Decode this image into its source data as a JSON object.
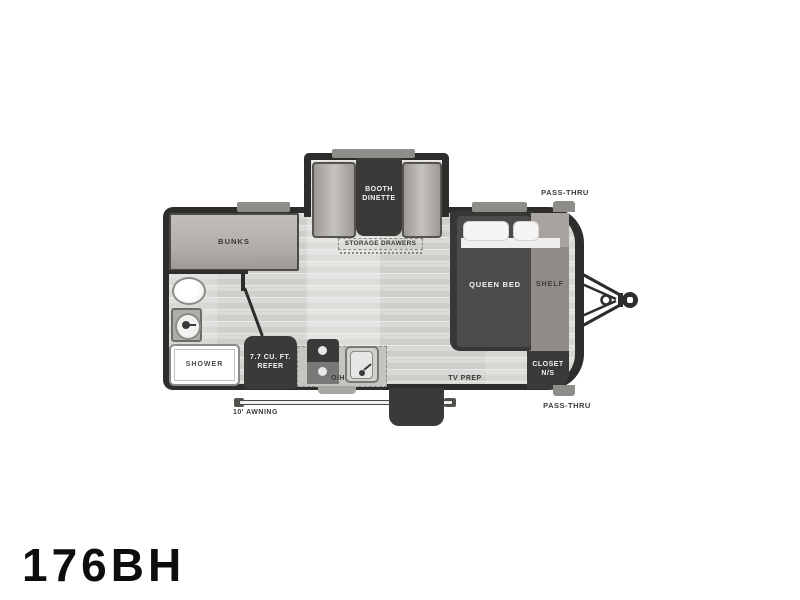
{
  "model": "176BH",
  "floorplan": {
    "labels": {
      "pass_thru_top": "PASS-THRU",
      "pass_thru_bottom": "PASS-THRU",
      "booth_dinette": "BOOTH DINETTE",
      "storage_drawers": "STORAGE DRAWERS",
      "bunks": "BUNKS",
      "queen_bed": "QUEEN BED",
      "shelf": "SHELF",
      "closet": "CLOSET N/S",
      "shower": "SHOWER",
      "refrigerator": "7.7 CU. FT. REFER",
      "overhead": "O/H",
      "tv_prep": "TV PREP",
      "awning": "10' AWNING"
    },
    "colors": {
      "wall": "#2e2d2c",
      "dark_furniture": "#3b3a38",
      "light_furniture": "#b3b0ab",
      "floor": "#d6d5d2",
      "shelf": "#8f8c88",
      "soft_white": "#f4f3f1"
    }
  }
}
